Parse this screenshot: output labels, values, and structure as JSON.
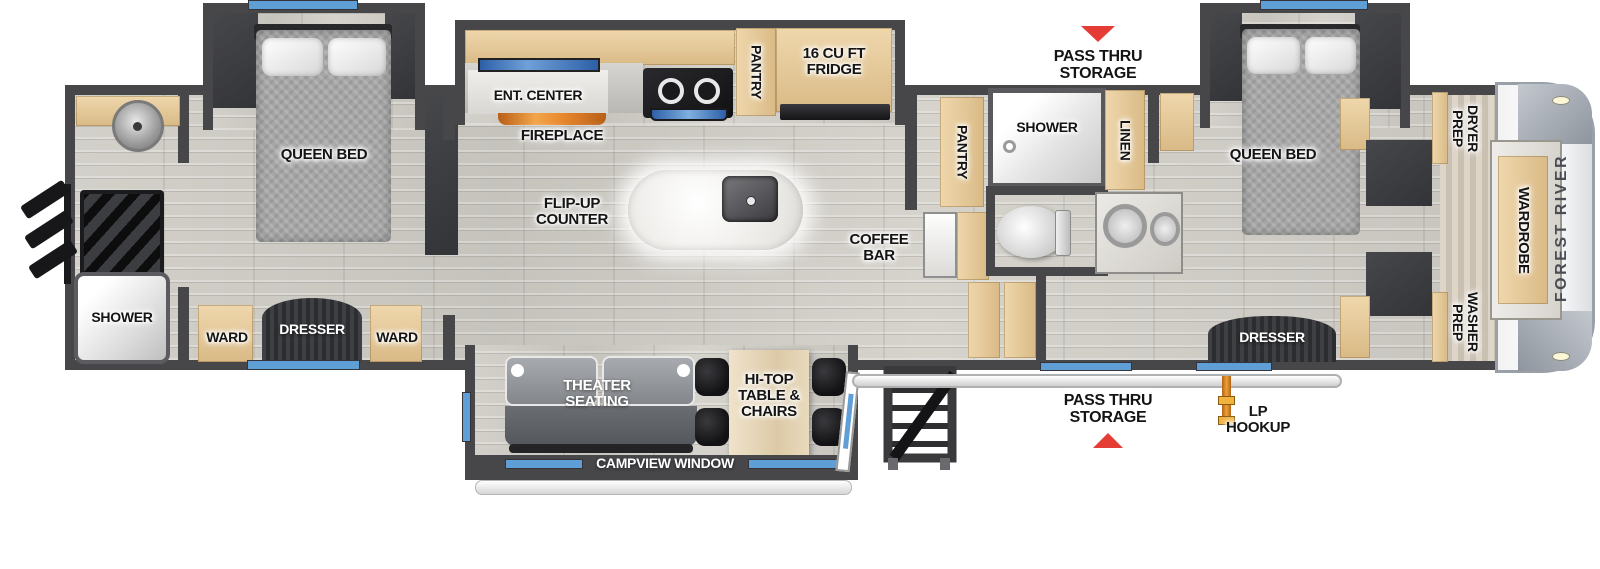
{
  "brand": "FOREST RIVER",
  "rooms": {
    "rear_bath": {
      "shower": "SHOWER"
    },
    "rear_bedroom": {
      "bed": "QUEEN BED",
      "ward_left": "WARD",
      "dresser": "DRESSER",
      "ward_right": "WARD"
    },
    "kitchen": {
      "ent_center": "ENT. CENTER",
      "fireplace": "FIREPLACE",
      "flip_up_counter": "FLIP-UP COUNTER",
      "pantry": "PANTRY",
      "fridge": "16 CU FT FRIDGE",
      "coffee_bar": "COFFEE BAR"
    },
    "living": {
      "theater_seating": "THEATER SEATING",
      "hi_top_table": "HI-TOP TABLE & CHAIRS",
      "campview_window": "CAMPVIEW WINDOW"
    },
    "mid_bath": {
      "pantry": "PANTRY",
      "shower": "SHOWER",
      "linen": "LINEN"
    },
    "front_bedroom": {
      "bed": "QUEEN BED",
      "dresser": "DRESSER"
    },
    "front_closet": {
      "dryer_prep": "DRYER PREP",
      "washer_prep": "WASHER PREP",
      "wardrobe": "WARDROBE"
    }
  },
  "exterior": {
    "pass_thru_top": "PASS THRU STORAGE",
    "pass_thru_bottom": "PASS THRU STORAGE",
    "lp_hookup": "LP HOOKUP"
  },
  "colors": {
    "wall": "#47474a",
    "window_blue": "#5f9fd6",
    "arrow_red": "#e63c36",
    "cabinet_tan": "#e5c693",
    "fireplace_orange": "#e8872e",
    "lp_orange": "#e08a28"
  }
}
